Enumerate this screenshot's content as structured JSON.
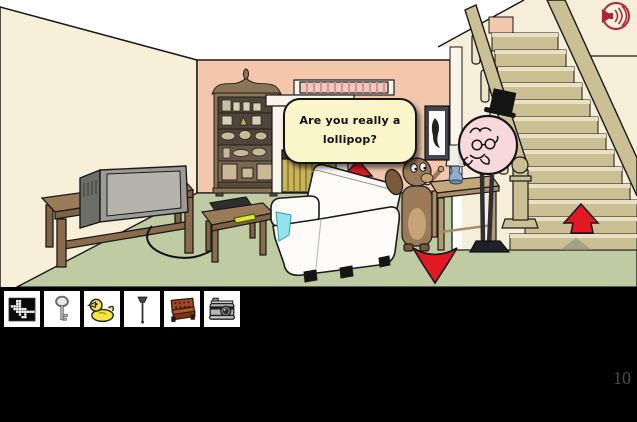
{
  "speech_bubble": {
    "text": "Are you really a lollipop?"
  },
  "hud": {
    "counter": "10"
  },
  "inventory": {
    "items": [
      {
        "id": "pixel-picture",
        "label": "pixel picture"
      },
      {
        "id": "key",
        "label": "key"
      },
      {
        "id": "rubber-duck",
        "label": "rubber duck"
      },
      {
        "id": "plunger",
        "label": "plunger"
      },
      {
        "id": "couch",
        "label": "couch"
      },
      {
        "id": "camera",
        "label": "camera"
      }
    ]
  },
  "icons": {
    "audio": "speaker-sound-on"
  },
  "colors": {
    "left_wall": "#F8EFD9",
    "back_wall": "#F2C7AC",
    "floor": "#BFCBA2",
    "stair_wood": "#CBC094",
    "arrow_red": "#E21822",
    "bubble_bg": "#FBF6C9",
    "speaker_red": "#B32430",
    "inventory_bg": "#000000",
    "counter_text": "#4B4B4B"
  }
}
